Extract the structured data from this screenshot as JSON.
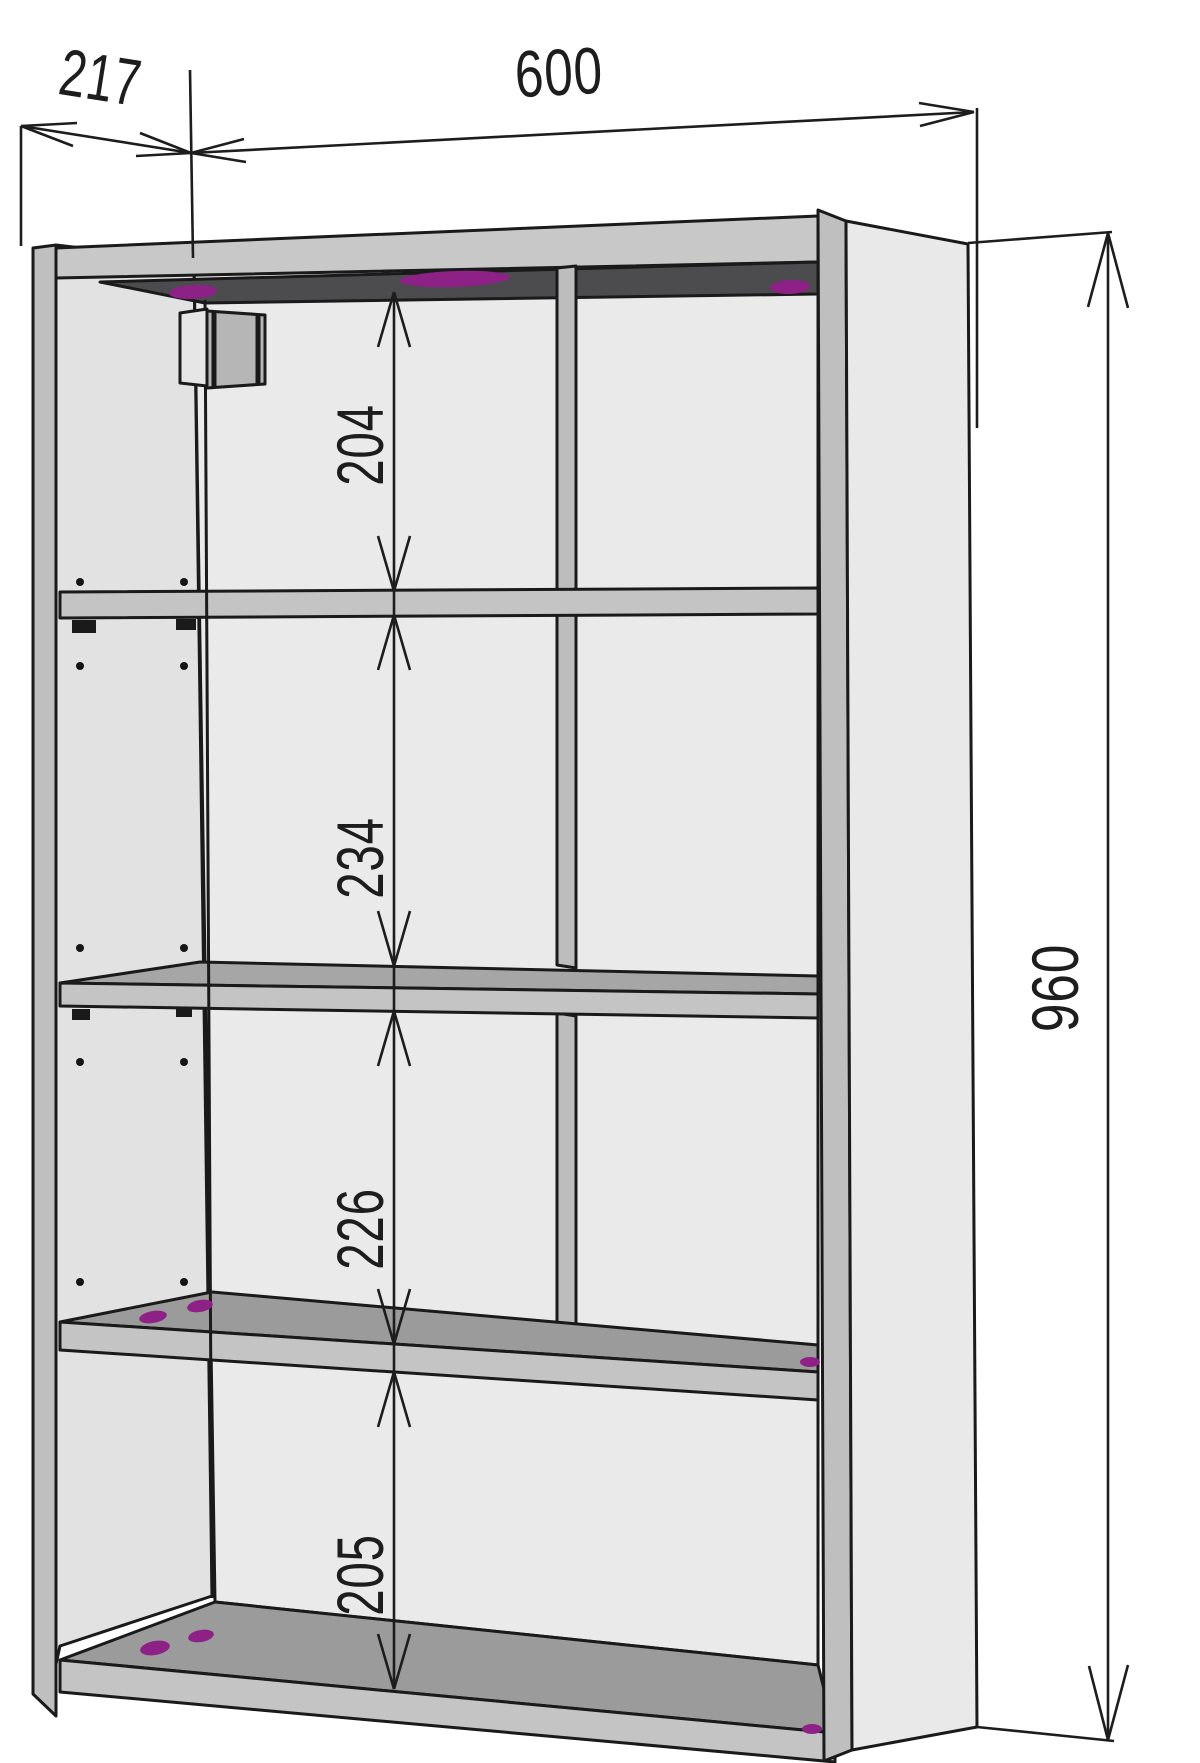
{
  "drawing": {
    "title": "Wall cabinet technical drawing",
    "subject": "Open wall-mounted shelf cabinet shown in perspective with overall and internal dimensions",
    "units": "mm",
    "dims": {
      "depth": {
        "value": "217",
        "location": "top-left, along cabinet depth"
      },
      "width": {
        "value": "600",
        "location": "top, along cabinet width"
      },
      "height": {
        "value": "960",
        "location": "right side, full height"
      }
    },
    "internal_heights": [
      {
        "value": "204",
        "compartment": "1st (top) opening"
      },
      {
        "value": "234",
        "compartment": "2nd opening"
      },
      {
        "value": "226",
        "compartment": "3rd opening"
      },
      {
        "value": "205",
        "compartment": "4th (bottom) opening"
      }
    ],
    "components": [
      "left side panel",
      "right side panel",
      "top panel",
      "three shelves",
      "bottom panel",
      "center vertical divider (upper three openings)",
      "wall-mount bracket at top-left",
      "shelf-pin holes on left inner face",
      "magenta fastener/dowel marks"
    ],
    "colors": {
      "background": "#ffffff",
      "outline": "#1a1a1a",
      "panel_light": "#eaeaea",
      "panel_inner": "#e2e2e2",
      "edge_strip": "#bfbfbf",
      "shelf_front": "#c4c4c4",
      "shelf_top_face": "#9b9b9b",
      "top_underside_dark": "#4c4c4f",
      "fastener_magenta": "#8e2186"
    }
  }
}
